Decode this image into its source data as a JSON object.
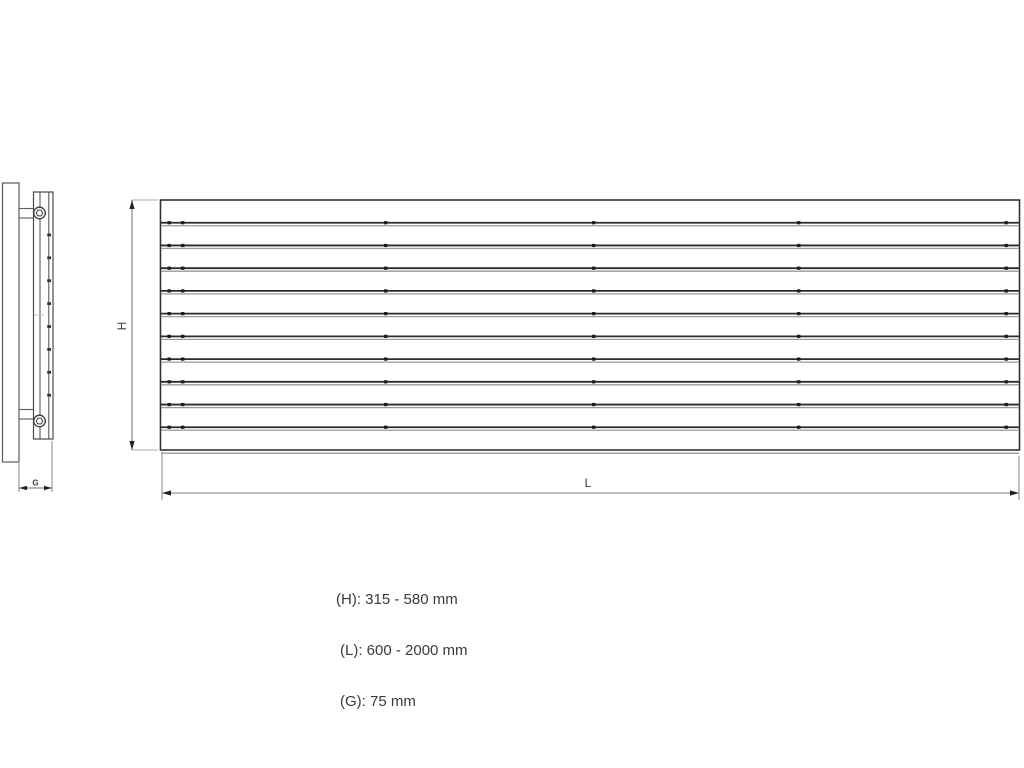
{
  "diagram": {
    "type": "radiator-dimension-drawing",
    "views": {
      "side_view": "radiator depth profile with wall brackets and valve connections",
      "front_view": "horizontal slat panel radiator"
    },
    "dimensions": {
      "height_label": "H",
      "length_label": "L",
      "depth_label": "G"
    },
    "panel": {
      "slat_divider_count": 10,
      "band_count": 11
    }
  },
  "legend": {
    "lines": [
      {
        "text": "(H): 315 - 580 mm"
      },
      {
        "text": "(L): 600 - 2000 mm"
      },
      {
        "text": "(G): 75 mm"
      }
    ]
  },
  "colors": {
    "background": "#ffffff",
    "line_dark": "#3c3c3c",
    "line_black": "#262626",
    "line_gray": "#979797",
    "text": "#3a3a3a"
  }
}
